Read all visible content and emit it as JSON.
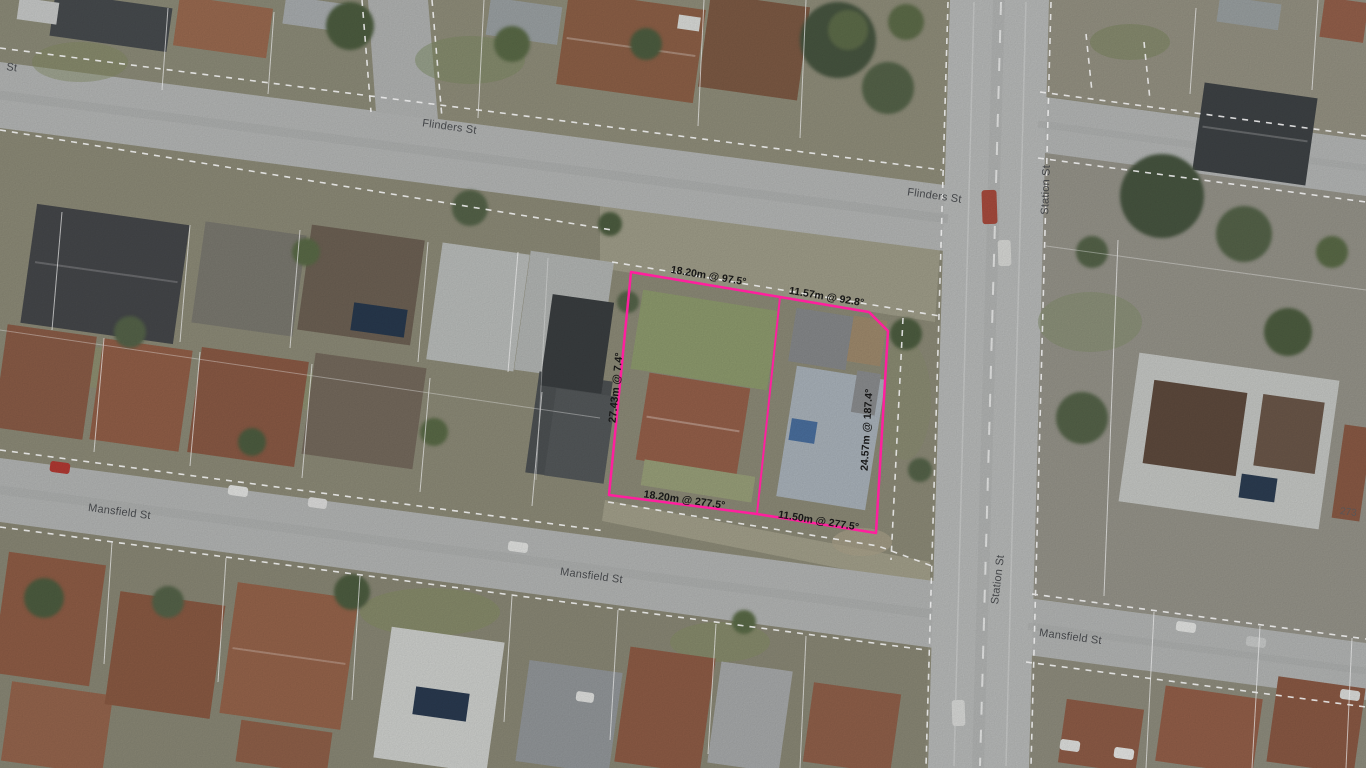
{
  "map": {
    "streets": {
      "edge_partial": "St",
      "flinders_west": "Flinders St",
      "flinders_east": "Flinders St",
      "station_north": "Station St",
      "station_south": "Station St",
      "mansfield_west": "Mansfield St",
      "mansfield_mid": "Mansfield St",
      "mansfield_east": "Mansfield St"
    },
    "selected_parcel": {
      "boundary_color": "#ff1f9e",
      "dim_top_left": "18.20m @ 97.5°",
      "dim_top_right": "11.57m @ 92.8°",
      "dim_right": "24.57m @ 187.4°",
      "dim_bottom_right": "11.50m @ 277.5°",
      "dim_bottom_left": "18.20m @ 277.5°",
      "dim_left": "27.43m @ 7.4°"
    },
    "house_numbers": {
      "east_block": "273"
    }
  }
}
